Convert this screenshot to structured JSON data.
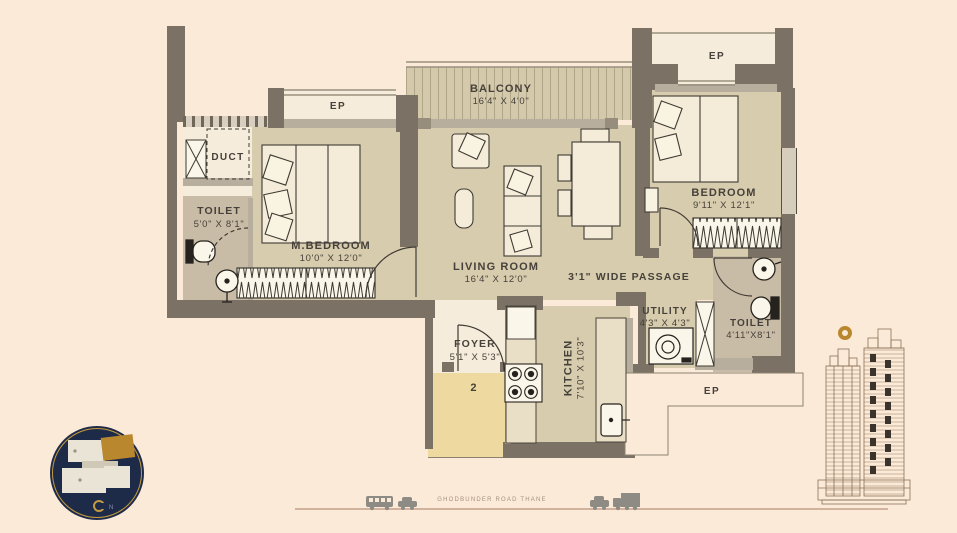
{
  "colors": {
    "background": "#fcead9",
    "wall_dark": "#7b7265",
    "wall_light": "#b7ae9e",
    "floor_tan": "#d8ccae",
    "floor_cream": "#f6ecdb",
    "floor_toilet": "#c9bca7",
    "lobby_yellow": "#eedaa0",
    "line_dark": "#3f3b33",
    "logo_navy": "#1d2b49",
    "brand_gold": "#b9882e"
  },
  "rooms": [
    {
      "id": "ep_top_left",
      "name": "EP",
      "dims": ""
    },
    {
      "id": "balcony",
      "name": "BALCONY",
      "dims": "16'4\" X 4'0\""
    },
    {
      "id": "ep_top_right",
      "name": "EP",
      "dims": ""
    },
    {
      "id": "duct",
      "name": "DUCT",
      "dims": ""
    },
    {
      "id": "toilet_left",
      "name": "TOILET",
      "dims": "5'0\" X 8'1\""
    },
    {
      "id": "m_bedroom",
      "name": "M.BEDROOM",
      "dims": "10'0\" X 12'0\""
    },
    {
      "id": "living_room",
      "name": "LIVING ROOM",
      "dims": "16'4\" X 12'0\""
    },
    {
      "id": "bedroom",
      "name": "BEDROOM",
      "dims": "9'11\" X 12'1\""
    },
    {
      "id": "passage",
      "name": "3'1\" WIDE PASSAGE",
      "dims": ""
    },
    {
      "id": "utility",
      "name": "UTILITY",
      "dims": "4'3\" X 4'3\""
    },
    {
      "id": "toilet_right",
      "name": "TOILET",
      "dims": "4'11\"X8'1\""
    },
    {
      "id": "foyer",
      "name": "FOYER",
      "dims": "5'1\" X 5'3\""
    },
    {
      "id": "kitchen",
      "name": "KITCHEN",
      "dims": "7'10\" X 10'3\""
    },
    {
      "id": "ep_bottom",
      "name": "EP",
      "dims": ""
    }
  ],
  "unit_number": "2",
  "road_label": "GHODBUNDER ROAD THANE",
  "key_plan": {
    "compass_label": "N"
  },
  "furniture": {
    "m_bedroom": [
      "double-bed",
      "wardrobe"
    ],
    "bedroom": [
      "double-bed",
      "wardrobe",
      "bedside-table"
    ],
    "living_room": [
      "sofa",
      "armchair",
      "side-table",
      "dining-table",
      "chairs"
    ],
    "kitchen": [
      "stove",
      "sink",
      "counter",
      "refrigerator"
    ],
    "toilet_left": [
      "wc",
      "washbasin"
    ],
    "toilet_right": [
      "wc",
      "washbasin"
    ],
    "utility": [
      "washing-machine"
    ],
    "shafts": [
      "duct-shaft",
      "utility-shaft"
    ]
  }
}
